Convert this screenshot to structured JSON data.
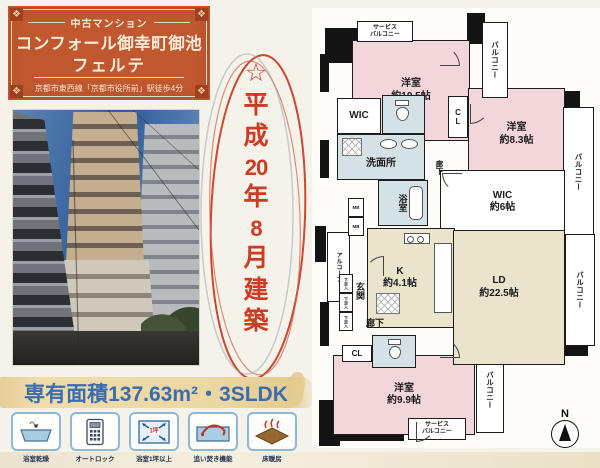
{
  "header": {
    "category": "中古マンション",
    "title": "コンフォール御幸町御池",
    "subtitle": "フェルテ",
    "access": "京都市東西線「京都市役所前」駅徒歩4分"
  },
  "highlight": {
    "segments": [
      "☆",
      "平",
      "成",
      "20",
      "年",
      "8",
      "月",
      "建",
      "築"
    ]
  },
  "area_banner": {
    "text": "専有面積137.63m²・3SLDK"
  },
  "features": [
    {
      "label": "浴室乾燥"
    },
    {
      "label": "オートロック"
    },
    {
      "label": "浴室1坪以上",
      "icon_text": "1坪"
    },
    {
      "label": "追い焚き機能"
    },
    {
      "label": "床暖房"
    }
  ],
  "floorplan": {
    "bedroom1": {
      "name": "洋室",
      "size": "約10.5帖"
    },
    "bedroom2": {
      "name": "洋室",
      "size": "約8.3帖"
    },
    "bedroom3": {
      "name": "洋室",
      "size": "約9.9帖"
    },
    "living": {
      "name": "LD",
      "size": "約22.5帖"
    },
    "kitchen": {
      "name": "K",
      "size": "約4.1帖"
    },
    "wic_small": "WIC",
    "wic_large": {
      "name": "WIC",
      "size": "約6帖"
    },
    "washroom": "洗面所",
    "bath": "浴室",
    "entrance": "玄関",
    "alcove": "アルコーブ",
    "hallway": "廊下",
    "closet": "CL",
    "balcony": "バルコニー",
    "service_balcony_line1": "サービス",
    "service_balcony_line2": "バルコニー",
    "meter_box": "MB",
    "shoe_box": "下足入",
    "compass": "N"
  },
  "colors": {
    "header_bg": "#c0572f",
    "highlight_red": "#d03a22",
    "banner_blue": "#3b6cb0",
    "banner_bg": "#ecd7a2",
    "room_pink": "#f2d6da",
    "room_beige": "#e9e4cb",
    "room_blue": "#d4e2e6"
  }
}
